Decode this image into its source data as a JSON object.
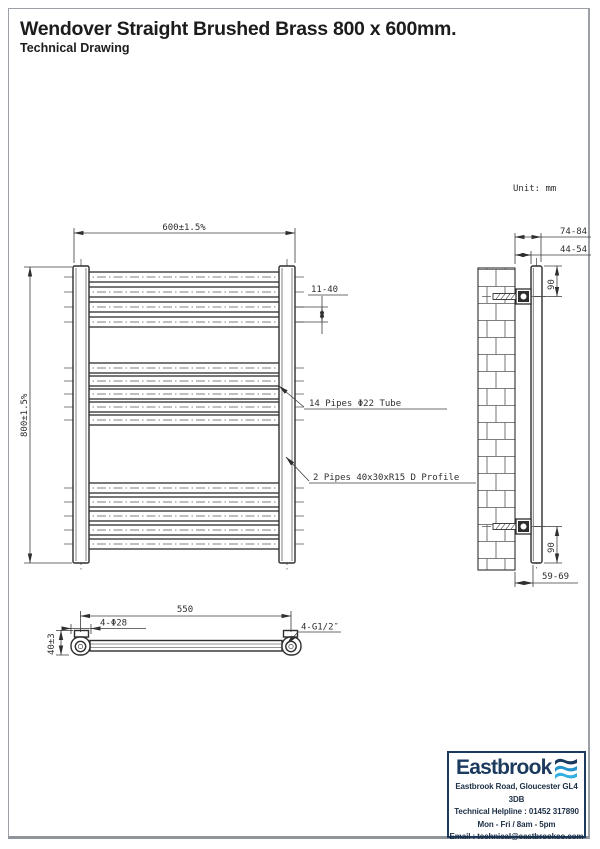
{
  "page": {
    "title": "Wendover Straight Brushed Brass 800 x 600mm.",
    "subtitle": "Technical Drawing",
    "unit_label": "Unit: mm"
  },
  "front_view": {
    "dim_width": "600±1.5%",
    "dim_height": "800±1.5%",
    "dim_pipe_spacing": "11-40",
    "label_pipes": "14 Pipes Φ22 Tube",
    "label_profile": "2 Pipes 40x30xR15 D Profile",
    "pipe_groups": [
      4,
      5,
      5
    ]
  },
  "side_view": {
    "dim_wall_to_front": "74-84",
    "dim_wall_to_back": "44-54",
    "dim_top_bracket": "90",
    "dim_bottom_bracket": "90",
    "dim_bottom_offset": "59-69"
  },
  "plan_view": {
    "dim_centres": "550",
    "dim_cap": "4-Φ28",
    "dim_depth": "40±3",
    "label_connection": "4-G1/2″"
  },
  "footer": {
    "brand": "Eastbrook",
    "address": "Eastbrook Road, Gloucester GL4 3DB",
    "helpline": "Technical Helpline : 01452 317890",
    "hours": "Mon - Fri / 8am - 5pm",
    "email": "Email : technical@eastbrookco.com"
  },
  "colors": {
    "line": "#2e2e2e",
    "navy": "#1b3a5e",
    "light_blue": "#2aa0d6",
    "page_border": "#9aa0a6"
  }
}
